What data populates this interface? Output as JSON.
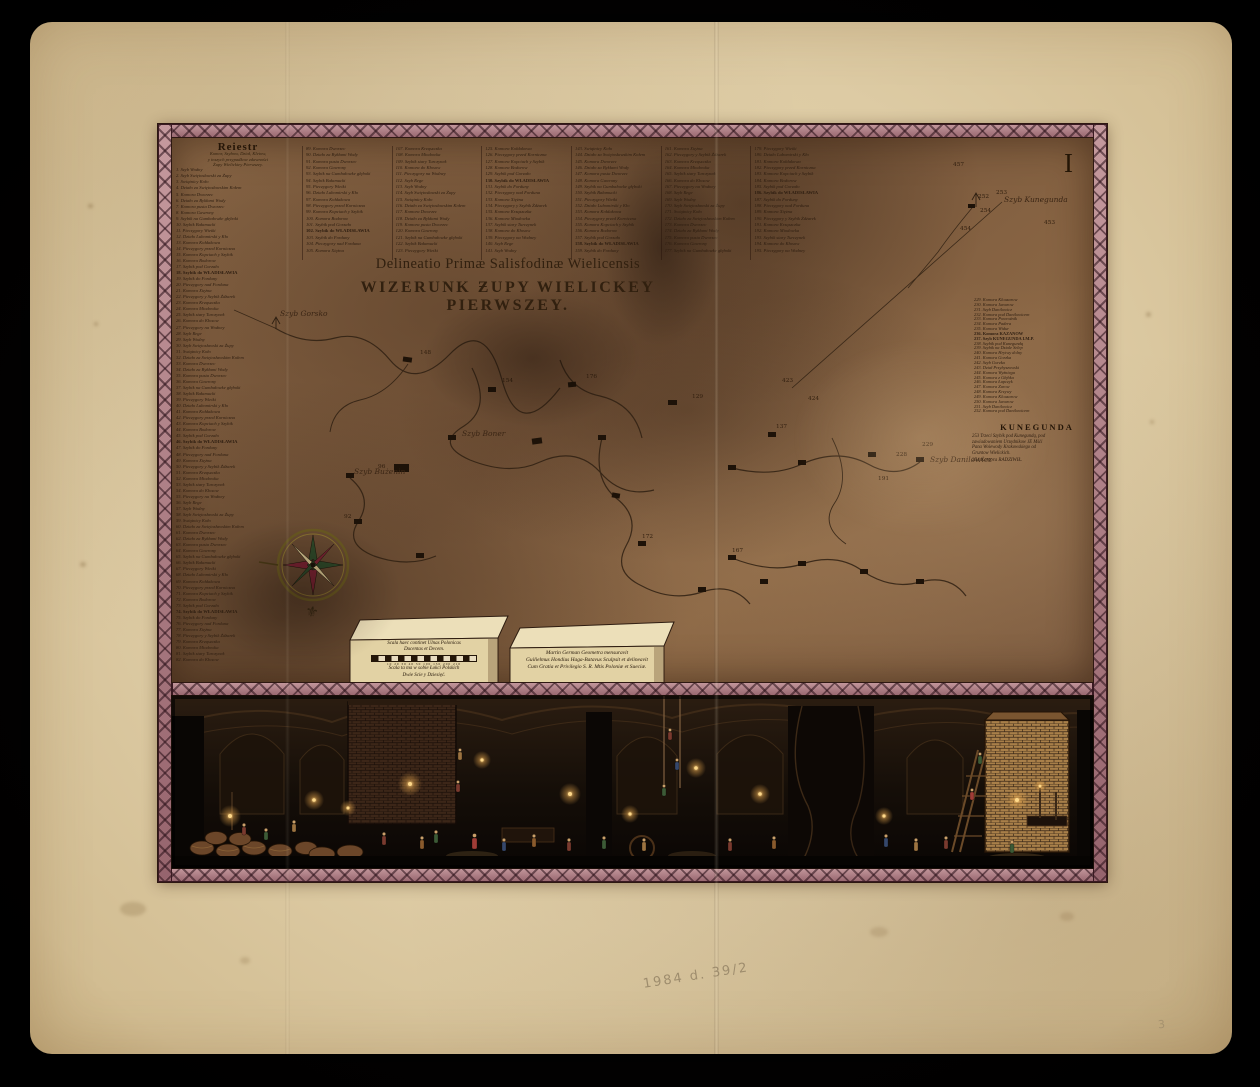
{
  "photo": {
    "pencil_note": "1984 d. 39/2",
    "pencil_mark": "3"
  },
  "plate": {
    "number": "I"
  },
  "title": {
    "latin": "Delineatio Primæ Salisfodinæ Wielicensis",
    "polish": "WIZERUNK ƵUPY WIELICKEY PIERWSZEY."
  },
  "legend": {
    "header": "Reiestr",
    "subtitle_lines": [
      "Komor, Szybow, Dział, Kletow,",
      "y inszych przypadkow zdawności",
      "Żupy Wielickiey Pierwszey."
    ],
    "sample_lines": [
      "Szyb Rege",
      "Szyb Wodny",
      "Szyb Swiętosławski za Żupy",
      "Swiątnicy Koło",
      "Działo za Swiętosławskim Kołem",
      "Komora Dworzec",
      "Działo za Bykłami Wody",
      "Komora pusta Dworzec",
      "Komora Gawrony",
      "Szybik na Gumbałowke głęboki",
      "Szybik Bałamucki",
      "Pieczygory Wietki",
      "Działo Lubomirski y Kło",
      "Komora Kołdakowa",
      "Pieczygory przed Korniczna",
      "Komora Kopciach y Szybik",
      "Komora Bodorow",
      "Szybik pod Gorzało",
      "Szybik do WŁADISŁAWIA",
      "Szybik do Forduny",
      "Pieczygory nad Forduna",
      "Komora Xiężna",
      "Pieczygory y Szybik Żdżarek",
      "Komora Krząszczka",
      "Komora Miodowka",
      "Szybik stary Turczynek",
      "Komora do Kłosow",
      "Pieczygory na Wodney"
    ],
    "right_samples": [
      "Komora Hrytwy dolny",
      "Komora Gorzka",
      "Szyb Gorzka",
      "Dział Przybyszowski",
      "Komora Wyźniega",
      "Komora z Głębka",
      "Komora Łapczyk",
      "Komora Żarow",
      "Komora Krzywy",
      "Komora Klouzarow",
      "Komora Janurow",
      "Szyb Danilowicz",
      "Komora pod Danilowicem",
      "Komora Powroźnik",
      "Komora Padera",
      "Komora Widur",
      "Komora KAZANOW",
      "Szyb KUNEGUNDA I.M.P.",
      "Szybik pod Kunegundą",
      "Szybik na Dziale Selep"
    ]
  },
  "kunegunda": {
    "header": "KUNEGUNDA",
    "paragraph_lines": [
      "253 Trzeci Szybik pod Kunegundą, pod",
      "zawiadowaniem Urzędnikow JE Mśći",
      "Pana Woiewody Krakowskiego od",
      "Gruntow Wielickich."
    ],
    "entry": "254 Komora RADZIWIŁ."
  },
  "scale_plinth": {
    "latin1": "Scala haec continet Ulnas Polonicas",
    "latin2": "Ducentas et Decem.",
    "ticks": "10 20 30 40 50  100  150  200 210",
    "polish1": "Scala ta ma w sobie Łokci Polskich",
    "polish2": "Dwie Scie y Dziesięć."
  },
  "imprint_plinth": {
    "line1": "Martin German Geometra mensuravit",
    "line2": "Guilielmus Hondius Haga-Batavus Sculpsit et delineavit",
    "line3": "Cum Gratia et Privilegio S. R. Mtis Poloniæ et Sueciæ."
  },
  "map": {
    "labels": [
      {
        "text": "Szyb Gorsko",
        "x": 108,
        "y": 178
      },
      {
        "text": "Szyb Bużenin",
        "x": 182,
        "y": 336
      },
      {
        "text": "Szyb Boner",
        "x": 290,
        "y": 298
      },
      {
        "text": "Szyb Danilowicz",
        "x": 758,
        "y": 324
      },
      {
        "text": "Szyb Kunegunda",
        "x": 832,
        "y": 64
      }
    ],
    "numbers": [
      {
        "t": "457",
        "x": 781,
        "y": 28
      },
      {
        "t": "252",
        "x": 806,
        "y": 60
      },
      {
        "t": "253",
        "x": 824,
        "y": 56
      },
      {
        "t": "254",
        "x": 808,
        "y": 74
      },
      {
        "t": "454",
        "x": 788,
        "y": 92
      },
      {
        "t": "453",
        "x": 872,
        "y": 86
      },
      {
        "t": "228",
        "x": 724,
        "y": 318
      },
      {
        "t": "229",
        "x": 750,
        "y": 308
      },
      {
        "t": "191",
        "x": 706,
        "y": 342
      },
      {
        "t": "148",
        "x": 248,
        "y": 216
      },
      {
        "t": "154",
        "x": 330,
        "y": 244
      },
      {
        "t": "176",
        "x": 414,
        "y": 240
      },
      {
        "t": "129",
        "x": 520,
        "y": 260
      },
      {
        "t": "137",
        "x": 604,
        "y": 290
      },
      {
        "t": "423",
        "x": 610,
        "y": 244
      },
      {
        "t": "424",
        "x": 636,
        "y": 262
      },
      {
        "t": "167",
        "x": 560,
        "y": 414
      },
      {
        "t": "172",
        "x": 470,
        "y": 400
      },
      {
        "t": "96",
        "x": 206,
        "y": 330
      },
      {
        "t": "92",
        "x": 172,
        "y": 380
      }
    ]
  },
  "colors": {
    "paper": "#ddcba4",
    "plate_background": "#7d5b3e",
    "ribbon_pink": "#b08287",
    "ribbon_dark": "#3a1a22",
    "ink": "#2e1d10",
    "frieze_background": "#0c0705",
    "candle_glow": "#f0c070"
  }
}
